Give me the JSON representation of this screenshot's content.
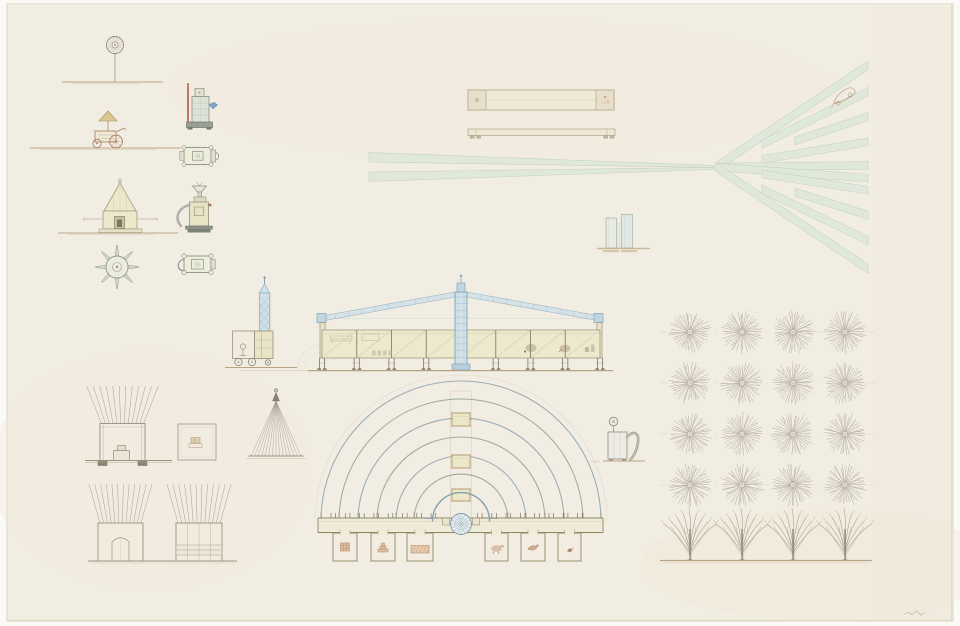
{
  "canvas": {
    "width": 960,
    "height": 626
  },
  "palette": {
    "bg": "#fbfaf6",
    "paper": "#f2ede2",
    "paperEdge": "#dcd2bf",
    "ink": "#938d80",
    "graphite": "#a7a197",
    "ground": "#b7a384",
    "paleYellow": "#ece8cb",
    "yellowLine": "#a39b7c",
    "blueFill": "#d3e1e9",
    "blueLine": "#8cb0c1",
    "blueDeep": "#7ba3b8",
    "green": "#e0e8db",
    "greenEdge": "#c3d2bd",
    "arcBlue": "#93a8b2",
    "arcOlive": "#9aa895",
    "olive": "#8d8865",
    "oliveDark": "#6e6952",
    "redBrown": "#a87a58",
    "redPipe": "#b24e39",
    "treeGray": "#a7a196",
    "treeTrunk": "#8e8779",
    "ghost": "#d8d0bd",
    "darkFoot": "#7c7668"
  },
  "figures": [
    {
      "kind": "rosettePole",
      "name": "rosette-pole-elevation",
      "cx": 115,
      "cy": 45,
      "r": 8.5,
      "groundY": 82,
      "gx0": 62,
      "gx1": 163
    },
    {
      "kind": "cart",
      "name": "vendor-cart-elevation",
      "cx": 108,
      "groundY": 148,
      "gx0": 30,
      "gx1": 181
    },
    {
      "kind": "towerPavilion",
      "name": "tower-pavilion-elevation",
      "cx": 120,
      "groundY": 233,
      "gx0": 58,
      "gx1": 178
    },
    {
      "kind": "wheelPlan",
      "name": "wheel-plan",
      "cx": 117,
      "cy": 267,
      "r": 11,
      "spokes": 8,
      "spokeLen": 10.5
    },
    {
      "kind": "espressoElev",
      "name": "espresso-machine-elevation"
    },
    {
      "kind": "machinePlanA",
      "name": "espresso-machine-plan"
    },
    {
      "kind": "grinderElev",
      "name": "grinder-machine-elevation"
    },
    {
      "kind": "machinePlanB",
      "name": "grinder-machine-plan"
    },
    {
      "kind": "bridgePlan",
      "name": "bridge-plan",
      "x": 468,
      "y": 90,
      "w": 146,
      "h": 20,
      "cap": 18
    },
    {
      "kind": "bridgeElev",
      "name": "bridge-elevation",
      "x": 468,
      "y": 129,
      "w": 147,
      "h": 6.5
    },
    {
      "kind": "roads",
      "name": "radiating-roads-plan",
      "x0": 369,
      "vx": 716,
      "vy": 167,
      "ex": 868,
      "band1": [
        152.5,
        162
      ],
      "band2": [
        172,
        181.5
      ],
      "angles": [
        -33.8,
        -26.4,
        -18.3,
        -9.4,
        -0.6,
        4.2,
        8.7,
        17.6,
        25.8,
        33.8
      ],
      "starts": [
        0,
        46,
        79,
        46,
        0,
        0,
        46,
        79,
        46,
        0
      ],
      "bw": 7.6
    },
    {
      "kind": "carSketch",
      "name": "car-sketch",
      "cx": 843,
      "cy": 96,
      "rot": -20
    },
    {
      "kind": "twinColumns",
      "name": "twin-columns-elevation"
    },
    {
      "kind": "ghostArcs",
      "name": "pencil-ghost-arcs"
    },
    {
      "kind": "serviceTower",
      "name": "service-tower-elevation"
    },
    {
      "kind": "hall",
      "name": "exhibition-hall-elevation",
      "x0": 322,
      "x1": 600,
      "wallTop": 330,
      "wallBot": 358,
      "mastX": 461,
      "bays": 8,
      "groundY": 370,
      "gx0": 308,
      "gx1": 613
    },
    {
      "kind": "amphitheater",
      "name": "amphitheater-plan",
      "cx": 461,
      "cy": 521,
      "radii": [
        140,
        122,
        103,
        84,
        65,
        47
      ],
      "uR": 28.5,
      "rosR": 10.5,
      "axTop": 391,
      "altars": [
        [
          413,
          13
        ],
        [
          455,
          13
        ],
        [
          489,
          12
        ]
      ],
      "sx0": 318,
      "sx1": 603,
      "st": 518,
      "sb": 532.5,
      "rooms": [
        [
          333,
          24
        ],
        [
          371,
          24
        ],
        [
          407,
          26
        ],
        [
          485,
          23
        ],
        [
          521,
          24
        ],
        [
          558,
          23
        ]
      ],
      "roomBot": 561
    },
    {
      "kind": "sprayer",
      "name": "sprayer-machine-elevation"
    },
    {
      "kind": "orchard",
      "name": "orchard-grid-plan",
      "cols": [
        690,
        742,
        793,
        845
      ],
      "rows": [
        332,
        383,
        434,
        485
      ],
      "r": 21.5,
      "rays": 38
    },
    {
      "kind": "treeRow",
      "name": "tree-row-elevation",
      "trunks": [
        690,
        742,
        793,
        845
      ],
      "groundY": 560,
      "gx0": 660,
      "gx1": 872
    },
    {
      "kind": "rayPavilion",
      "name": "ray-pavilion-elevation"
    },
    {
      "kind": "squarePlan",
      "name": "pavilion-plan",
      "x": 178,
      "y": 424,
      "w": 38,
      "h": 36
    },
    {
      "kind": "rayCone",
      "name": "ray-cone-elevation",
      "ax": 276,
      "ay": 401,
      "baseY": 456,
      "bx0": 251,
      "bx1": 301
    },
    {
      "kind": "rayBox",
      "name": "ray-box-elevation-a",
      "x": 98,
      "y": 523,
      "w": 45,
      "bot": 561,
      "variant": "door"
    },
    {
      "kind": "rayBox",
      "name": "ray-box-elevation-b",
      "x": 176,
      "y": 523,
      "w": 46,
      "bot": 561,
      "variant": "slats"
    },
    {
      "kind": "groundLine",
      "name": "ray-box-ground",
      "x0": 88,
      "x1": 237,
      "y": 561
    },
    {
      "kind": "signature",
      "name": "signature-scribble",
      "x": 905,
      "y": 613
    }
  ]
}
